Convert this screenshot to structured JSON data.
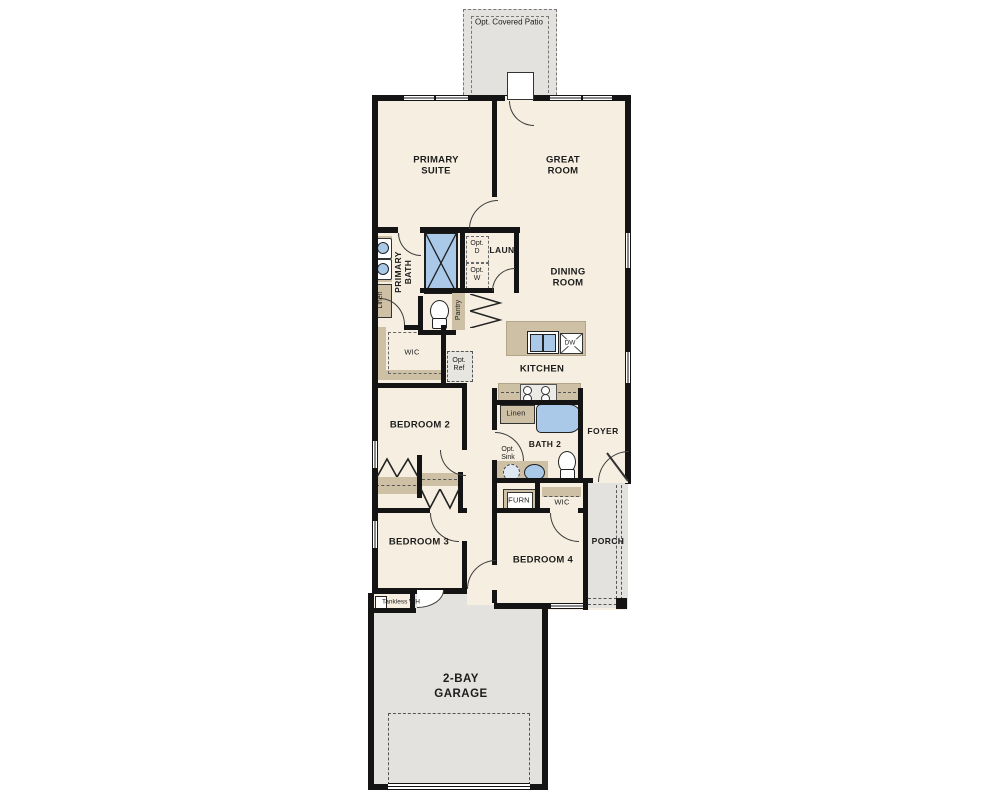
{
  "labels": {
    "patio": "Opt. Covered Patio",
    "primary_suite": "PRIMARY SUITE",
    "great_room": "GREAT ROOM",
    "primary_bath": "PRIMARY BATH",
    "laun": "LAUN",
    "linen_primary": "Linen",
    "pantry": "Pantry",
    "opt_d": "Opt. D",
    "opt_w": "Opt. W",
    "dining": "DINING ROOM",
    "wic_primary": "WIC",
    "opt_ref": "Opt. Ref",
    "kitchen": "KITCHEN",
    "dw": "DW",
    "bedroom2": "BEDROOM 2",
    "linen_bath2": "Linen",
    "bath2": "BATH 2",
    "foyer": "FOYER",
    "opt_sink": "Opt. Sink",
    "furn": "FURN",
    "wic_bed4": "WIC",
    "bedroom3": "BEDROOM 3",
    "bedroom4": "BEDROOM 4",
    "porch": "PORCH",
    "tankless": "Tankless WH",
    "garage": "2-BAY GARAGE"
  },
  "colors": {
    "floor": "#f6efe1",
    "exterior": "#e3e2de",
    "cabinet": "#cec0a5",
    "fixture_blue": "#aac9e9",
    "wall": "#141414"
  }
}
